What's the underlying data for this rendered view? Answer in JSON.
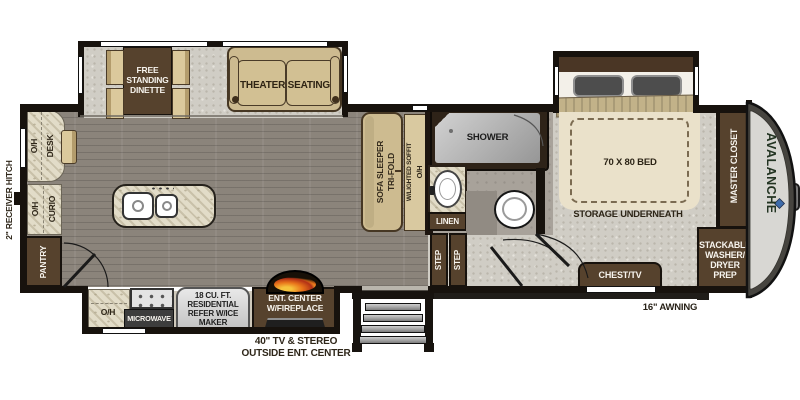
{
  "brand": {
    "name": "AVALANCHE"
  },
  "exterior": {
    "receiver_hitch": "2\" RECEIVER HITCH",
    "awning": "16\" AWNING",
    "outside_caption": "40\" TV & STEREO\nOUTSIDE ENT. CENTER"
  },
  "living_area": {
    "dinette": "FREE\nSTANDING\nDINETTE",
    "theater_seating": "THEATER SEATING",
    "sofa_line1": "TRI-FOLD",
    "sofa_line2": "SOFA SLEEPER",
    "soffit_line1": "O/H",
    "soffit_line2": "W/LIGHTED SOFFIT",
    "desk_oh": "O/H",
    "desk": "DESK",
    "curio_oh": "O/H",
    "curio": "CURIO",
    "pantry": "PANTRY"
  },
  "kitchen": {
    "overhead": "O/H",
    "microwave": "MICROWAVE",
    "refrigerator": "18 CU. FT.\nRESIDENTIAL\nREFER W/ICE\nMAKER",
    "entertainment_center": "ENT. CENTER\nW/FIREPLACE"
  },
  "bathroom": {
    "shower": "SHOWER",
    "linen": "LINEN",
    "steps": [
      "STEP",
      "STEP"
    ]
  },
  "bedroom": {
    "bed": "70 X 80 BED",
    "storage": "STORAGE UNDERNEATH",
    "chest_tv": "CHEST/TV",
    "master_closet": "MASTER CLOSET",
    "laundry": "STACKABLE\nWASHER/\nDRYER\nPREP"
  },
  "colors": {
    "cabinet_brown": "#56422d",
    "furniture_tan": "#cdbb90",
    "wall_black": "#17120d",
    "wood_floor": "#8b847b",
    "carpet": "#d0cdc5",
    "counter_marble": "#e2dcc8",
    "brand_text": "#233422",
    "logo_blue": "#3e6cab",
    "flame_orange": "#e8731a"
  }
}
